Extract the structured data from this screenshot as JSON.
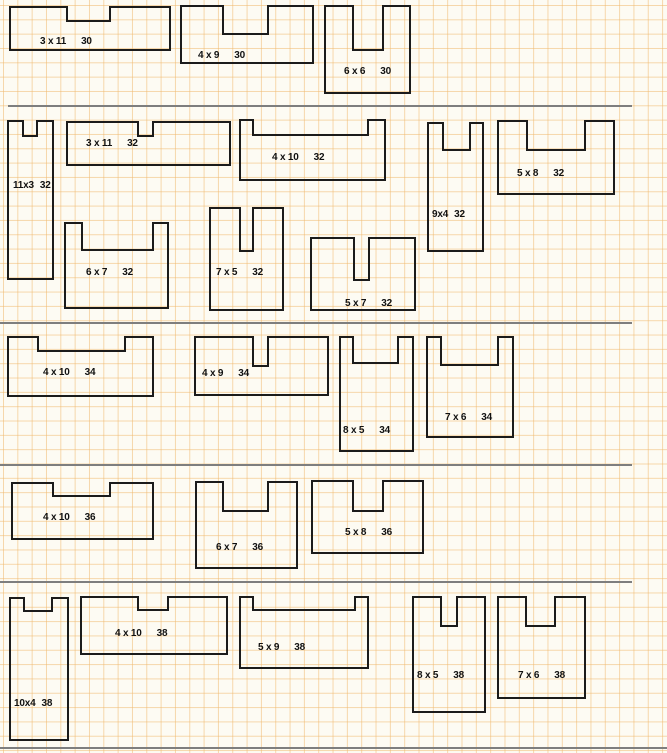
{
  "page": {
    "width": 667,
    "height": 753
  },
  "paper": {
    "background_color": "#FDFBF3",
    "grid_line_color": "#F0B96E",
    "grid_size_px": 14.33,
    "grid_offset_x": 3,
    "grid_offset_y": 5,
    "shape_outline_color": "#1B1B1B",
    "divider_color": "#7E7E7E",
    "label_color": "#111111"
  },
  "sections": [
    {
      "group_perimeter": "30",
      "shapes": [
        {
          "dims": "3 x 11",
          "perimeter": "30",
          "x": 10,
          "y": 7,
          "w": 160,
          "h": 43,
          "notch": {
            "nx": 57,
            "nw": 43,
            "nd": 14
          },
          "label": {
            "x": 40,
            "y": 36,
            "compact": false
          }
        },
        {
          "dims": "4 x 9",
          "perimeter": "30",
          "x": 181,
          "y": 6,
          "w": 132,
          "h": 57,
          "notch": {
            "nx": 42,
            "nw": 45,
            "nd": 28
          },
          "label": {
            "x": 198,
            "y": 50,
            "compact": false
          }
        },
        {
          "dims": "6 x 6",
          "perimeter": "30",
          "x": 325,
          "y": 6,
          "w": 85,
          "h": 87,
          "notch": {
            "nx": 28,
            "nw": 30,
            "nd": 44
          },
          "label": {
            "x": 344,
            "y": 66,
            "compact": false
          }
        }
      ]
    },
    {
      "group_perimeter": "32",
      "shapes": [
        {
          "dims": "11x3",
          "perimeter": "32",
          "x": 8,
          "y": 121,
          "w": 45,
          "h": 158,
          "notch": {
            "nx": 15,
            "nw": 14,
            "nd": 15
          },
          "label": {
            "x": 13,
            "y": 180,
            "compact": true
          }
        },
        {
          "dims": "3 x 11",
          "perimeter": "32",
          "x": 67,
          "y": 122,
          "w": 163,
          "h": 43,
          "notch": {
            "nx": 71,
            "nw": 15,
            "nd": 14
          },
          "label": {
            "x": 86,
            "y": 138,
            "compact": false
          }
        },
        {
          "dims": "4 x 10",
          "perimeter": "32",
          "x": 240,
          "y": 120,
          "w": 145,
          "h": 60,
          "notch": {
            "nx": 13,
            "nw": 115,
            "nd": 15
          },
          "label": {
            "x": 272,
            "y": 152,
            "compact": false
          }
        },
        {
          "dims": "9x4",
          "perimeter": "32",
          "x": 428,
          "y": 123,
          "w": 55,
          "h": 128,
          "notch": {
            "nx": 15,
            "nw": 27,
            "nd": 27
          },
          "label": {
            "x": 432,
            "y": 209,
            "compact": true
          }
        },
        {
          "dims": "5 x 8",
          "perimeter": "32",
          "x": 498,
          "y": 121,
          "w": 116,
          "h": 73,
          "notch": {
            "nx": 29,
            "nw": 58,
            "nd": 29
          },
          "label": {
            "x": 517,
            "y": 168,
            "compact": false
          }
        },
        {
          "dims": "6 x 7",
          "perimeter": "32",
          "x": 65,
          "y": 223,
          "w": 103,
          "h": 85,
          "notch": {
            "nx": 17,
            "nw": 71,
            "nd": 27
          },
          "label": {
            "x": 86,
            "y": 267,
            "compact": false
          }
        },
        {
          "dims": "7 x 5",
          "perimeter": "32",
          "x": 210,
          "y": 208,
          "w": 73,
          "h": 102,
          "notch": {
            "nx": 30,
            "nw": 13,
            "nd": 43
          },
          "label": {
            "x": 216,
            "y": 267,
            "compact": false
          }
        },
        {
          "dims": "5 x 7",
          "perimeter": "32",
          "x": 311,
          "y": 238,
          "w": 104,
          "h": 72,
          "notch": {
            "nx": 43,
            "nw": 15,
            "nd": 42
          },
          "label": {
            "x": 345,
            "y": 298,
            "compact": false
          }
        }
      ]
    },
    {
      "group_perimeter": "34",
      "shapes": [
        {
          "dims": "4 x 10",
          "perimeter": "34",
          "x": 8,
          "y": 337,
          "w": 145,
          "h": 59,
          "notch": {
            "nx": 30,
            "nw": 87,
            "nd": 14
          },
          "label": {
            "x": 43,
            "y": 367,
            "compact": false
          }
        },
        {
          "dims": "4 x 9",
          "perimeter": "34",
          "x": 195,
          "y": 337,
          "w": 133,
          "h": 58,
          "notch": {
            "nx": 58,
            "nw": 15,
            "nd": 29
          },
          "label": {
            "x": 202,
            "y": 368,
            "compact": false
          }
        },
        {
          "dims": "8 x 5",
          "perimeter": "34",
          "x": 340,
          "y": 337,
          "w": 73,
          "h": 114,
          "notch": {
            "nx": 13,
            "nw": 45,
            "nd": 26
          },
          "label": {
            "x": 343,
            "y": 425,
            "compact": false
          }
        },
        {
          "dims": "7 x 6",
          "perimeter": "34",
          "x": 427,
          "y": 337,
          "w": 86,
          "h": 100,
          "notch": {
            "nx": 14,
            "nw": 57,
            "nd": 28
          },
          "label": {
            "x": 445,
            "y": 412,
            "compact": false
          }
        }
      ]
    },
    {
      "group_perimeter": "36",
      "shapes": [
        {
          "dims": "4 x 10",
          "perimeter": "36",
          "x": 12,
          "y": 483,
          "w": 141,
          "h": 56,
          "notch": {
            "nx": 41,
            "nw": 57,
            "nd": 13
          },
          "label": {
            "x": 43,
            "y": 512,
            "compact": false
          }
        },
        {
          "dims": "6 x 7",
          "perimeter": "36",
          "x": 196,
          "y": 482,
          "w": 101,
          "h": 86,
          "notch": {
            "nx": 27,
            "nw": 45,
            "nd": 29
          },
          "label": {
            "x": 216,
            "y": 542,
            "compact": false
          }
        },
        {
          "dims": "5 x 8",
          "perimeter": "36",
          "x": 312,
          "y": 481,
          "w": 111,
          "h": 72,
          "notch": {
            "nx": 41,
            "nw": 30,
            "nd": 30
          },
          "label": {
            "x": 345,
            "y": 527,
            "compact": false
          }
        }
      ]
    },
    {
      "group_perimeter": "38",
      "shapes": [
        {
          "dims": "10x4",
          "perimeter": "38",
          "x": 10,
          "y": 598,
          "w": 58,
          "h": 142,
          "notch": {
            "nx": 14,
            "nw": 28,
            "nd": 13
          },
          "label": {
            "x": 14,
            "y": 698,
            "compact": true
          }
        },
        {
          "dims": "4 x 10",
          "perimeter": "38",
          "x": 81,
          "y": 597,
          "w": 146,
          "h": 57,
          "notch": {
            "nx": 57,
            "nw": 30,
            "nd": 13
          },
          "label": {
            "x": 115,
            "y": 628,
            "compact": false
          }
        },
        {
          "dims": "5 x 9",
          "perimeter": "38",
          "x": 240,
          "y": 597,
          "w": 128,
          "h": 71,
          "notch": {
            "nx": 13,
            "nw": 102,
            "nd": 13
          },
          "label": {
            "x": 258,
            "y": 642,
            "compact": false
          }
        },
        {
          "dims": "8 x 5",
          "perimeter": "38",
          "x": 413,
          "y": 597,
          "w": 72,
          "h": 115,
          "notch": {
            "nx": 28,
            "nw": 16,
            "nd": 29
          },
          "label": {
            "x": 417,
            "y": 670,
            "compact": false
          }
        },
        {
          "dims": "7 x 6",
          "perimeter": "38",
          "x": 498,
          "y": 597,
          "w": 87,
          "h": 101,
          "notch": {
            "nx": 28,
            "nw": 29,
            "nd": 29
          },
          "label": {
            "x": 518,
            "y": 670,
            "compact": false
          }
        }
      ]
    }
  ],
  "dividers": [
    {
      "y": 106,
      "x1": 8,
      "x2": 632
    },
    {
      "y": 323,
      "x1": 0,
      "x2": 632
    },
    {
      "y": 465,
      "x1": 0,
      "x2": 632
    },
    {
      "y": 582,
      "x1": 0,
      "x2": 632
    },
    {
      "y": 748,
      "x1": 0,
      "x2": 667
    }
  ]
}
